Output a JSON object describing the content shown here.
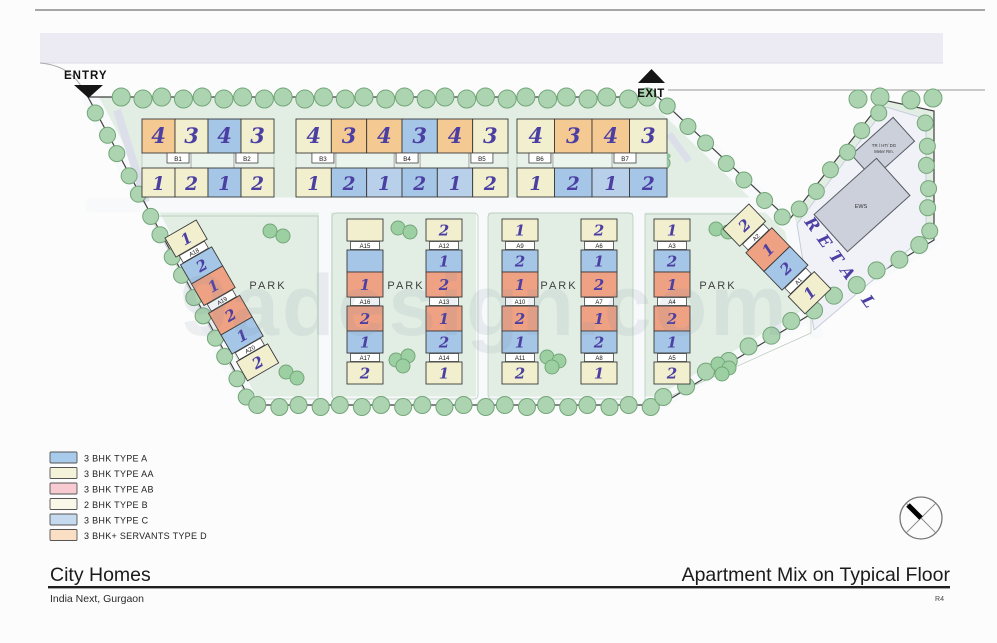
{
  "plan": {
    "entry_label": "ENTRY",
    "exit_label": "EXIT",
    "park_label": "PARK",
    "retail_label": "RETAIL",
    "watermark": "9adesign.com",
    "retail_buildings": {
      "meter_room_line1": "TR / HT/ DG",
      "meter_room_line2": "Meter Rm.",
      "ews": "EWS"
    }
  },
  "top_buildings": [
    {
      "labels": [
        "B1",
        "B2"
      ],
      "top_cells": [
        {
          "c": "orange",
          "n": "4"
        },
        {
          "c": "cream",
          "n": "3"
        },
        {
          "c": "blue",
          "n": "4"
        },
        {
          "c": "cream",
          "n": "3"
        }
      ],
      "bottom_cells": [
        {
          "c": "cream",
          "n": "1"
        },
        {
          "c": "cream",
          "n": "2"
        },
        {
          "c": "blue",
          "n": "1"
        },
        {
          "c": "cream",
          "n": "2"
        }
      ]
    },
    {
      "labels": [
        "B3",
        "B4",
        "B5"
      ],
      "top_cells": [
        {
          "c": "cream",
          "n": "4"
        },
        {
          "c": "orange",
          "n": "3"
        },
        {
          "c": "orange",
          "n": "4"
        },
        {
          "c": "blue",
          "n": "3"
        },
        {
          "c": "orange",
          "n": "4"
        },
        {
          "c": "cream",
          "n": "3"
        }
      ],
      "bottom_cells": [
        {
          "c": "cream",
          "n": "1"
        },
        {
          "c": "blue",
          "n": "2"
        },
        {
          "c": "lightblue",
          "n": "1"
        },
        {
          "c": "blue",
          "n": "2"
        },
        {
          "c": "lightblue",
          "n": "1"
        },
        {
          "c": "cream",
          "n": "2"
        }
      ]
    },
    {
      "labels": [
        "B6",
        "B7"
      ],
      "top_cells": [
        {
          "c": "cream",
          "n": "4"
        },
        {
          "c": "orange",
          "n": "3"
        },
        {
          "c": "orange",
          "n": "4"
        },
        {
          "c": "cream",
          "n": "3"
        }
      ],
      "bottom_cells": [
        {
          "c": "cream",
          "n": "1"
        },
        {
          "c": "blue",
          "n": "2"
        },
        {
          "c": "lightblue",
          "n": "1"
        },
        {
          "c": "blue",
          "n": "2"
        }
      ]
    }
  ],
  "tower_strips": [
    {
      "id": "A18-A20",
      "cells": [
        {
          "c": "cream",
          "n": "1"
        },
        {
          "chip": "A18"
        },
        {
          "c": "blue",
          "n": "2"
        },
        {
          "c": "salmon",
          "n": "1"
        },
        {
          "chip": "A19"
        },
        {
          "c": "salmon",
          "n": "2"
        },
        {
          "c": "blue",
          "n": "1"
        },
        {
          "chip": "A20"
        },
        {
          "c": "cream",
          "n": "2"
        }
      ]
    },
    {
      "id": "A15-A17",
      "cells": [
        {
          "c": "cream",
          "n": ""
        },
        {
          "chip": "A15"
        },
        {
          "c": "blue",
          "n": ""
        },
        {
          "c": "salmon",
          "n": "1"
        },
        {
          "chip": "A16"
        },
        {
          "c": "salmon",
          "n": "2"
        },
        {
          "c": "blue",
          "n": "1"
        },
        {
          "chip": "A17"
        },
        {
          "c": "cream",
          "n": "2"
        }
      ]
    },
    {
      "id": "A12-A14",
      "cells": [
        {
          "c": "cream",
          "n": "2"
        },
        {
          "chip": "A12"
        },
        {
          "c": "blue",
          "n": "1"
        },
        {
          "c": "salmon",
          "n": "2"
        },
        {
          "chip": "A13"
        },
        {
          "c": "salmon",
          "n": "1"
        },
        {
          "c": "blue",
          "n": "2"
        },
        {
          "chip": "A14"
        },
        {
          "c": "cream",
          "n": "1"
        }
      ]
    },
    {
      "id": "A9-A11",
      "cells": [
        {
          "c": "cream",
          "n": "1"
        },
        {
          "chip": "A9"
        },
        {
          "c": "blue",
          "n": "2"
        },
        {
          "c": "salmon",
          "n": "1"
        },
        {
          "chip": "A10"
        },
        {
          "c": "salmon",
          "n": "2"
        },
        {
          "c": "blue",
          "n": "1"
        },
        {
          "chip": "A11"
        },
        {
          "c": "cream",
          "n": "2"
        }
      ]
    },
    {
      "id": "A6-A8",
      "cells": [
        {
          "c": "cream",
          "n": "2"
        },
        {
          "chip": "A6"
        },
        {
          "c": "blue",
          "n": "1"
        },
        {
          "c": "salmon",
          "n": "2"
        },
        {
          "chip": "A7"
        },
        {
          "c": "salmon",
          "n": "1"
        },
        {
          "c": "blue",
          "n": "2"
        },
        {
          "chip": "A8"
        },
        {
          "c": "cream",
          "n": "1"
        }
      ]
    },
    {
      "id": "A3-A5",
      "cells": [
        {
          "c": "cream",
          "n": "1"
        },
        {
          "chip": "A3"
        },
        {
          "c": "blue",
          "n": "2"
        },
        {
          "c": "salmon",
          "n": "1"
        },
        {
          "chip": "A4"
        },
        {
          "c": "salmon",
          "n": "2"
        },
        {
          "c": "blue",
          "n": "1"
        },
        {
          "chip": "A5"
        },
        {
          "c": "cream",
          "n": "2"
        }
      ]
    },
    {
      "id": "A1-A2",
      "cells": [
        {
          "c": "cream",
          "n": "2"
        },
        {
          "chip": "A2"
        },
        {
          "c": "salmon",
          "n": "1"
        },
        {
          "c": "blue",
          "n": "2"
        },
        {
          "chip": "A1"
        },
        {
          "c": "cream",
          "n": "1"
        }
      ]
    }
  ],
  "legend": {
    "items": [
      {
        "label": "3 BHK TYPE A",
        "color": "#a8cbec"
      },
      {
        "label": "3 BHK TYPE AA",
        "color": "#f5f2da"
      },
      {
        "label": "3 BHK TYPE AB",
        "color": "#f8cad1"
      },
      {
        "label": "2 BHK TYPE B",
        "color": "#faf6e8"
      },
      {
        "label": "3 BHK TYPE C",
        "color": "#c5d9ef"
      },
      {
        "label": "3 BHK+ SERVANTS TYPE D",
        "color": "#fbdfc5"
      }
    ]
  },
  "title_block": {
    "project": "City Homes",
    "location": "India Next, Gurgaon",
    "sheet_title": "Apartment Mix on Typical Floor",
    "revision": "R4"
  },
  "colors": {
    "unit_cream": "#f1efce",
    "unit_blue": "#a5c6e7",
    "unit_lightblue": "#b9d0ea",
    "unit_salmon": "#efa183",
    "unit_orange": "#f5c992",
    "ink": "#4c3fa3",
    "site_green": "#e2eee4",
    "tree": "#acd4b0",
    "road_band": "#ecebf4",
    "retail_fill": "#f1f1f8",
    "gray_building": "#cbd0da"
  }
}
